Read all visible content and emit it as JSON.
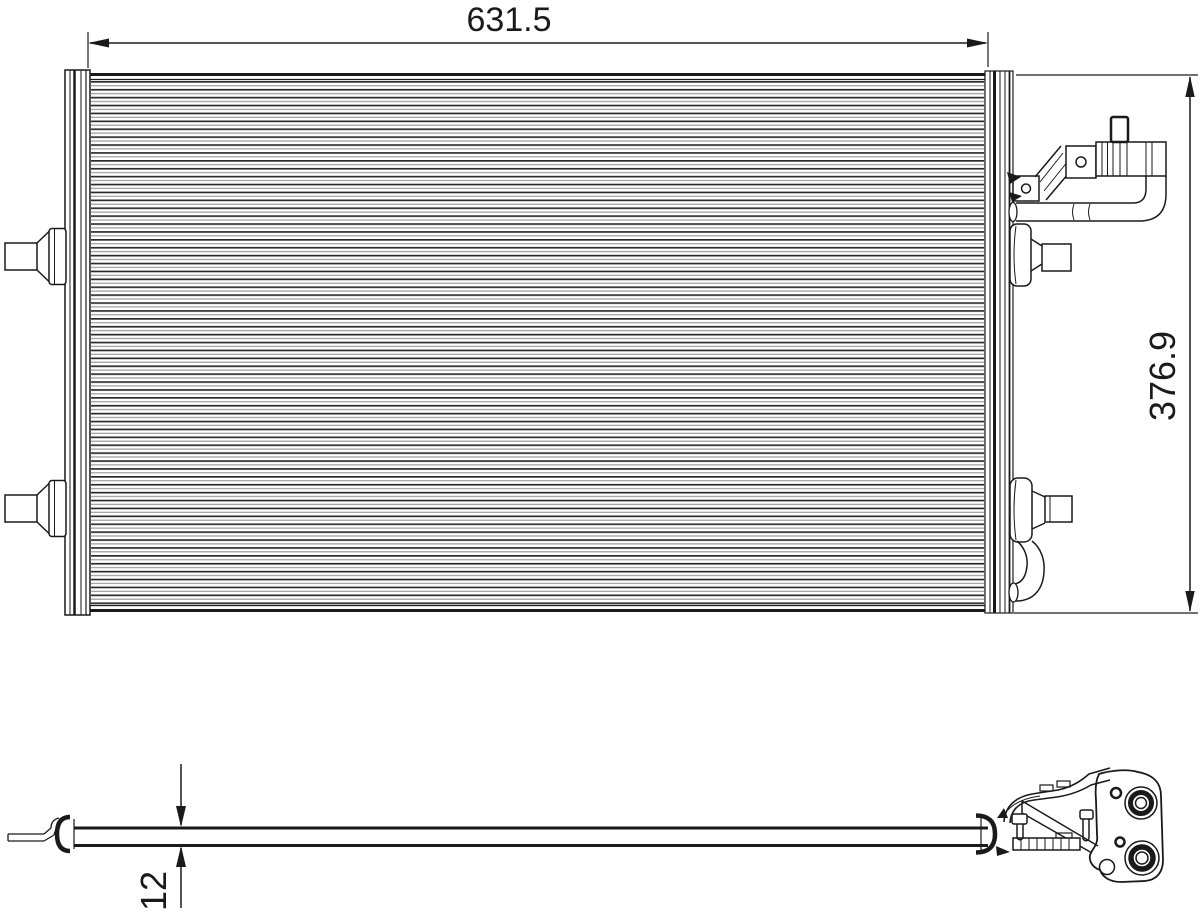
{
  "page": {
    "background_color": "#ffffff"
  },
  "drawing": {
    "line_color": "#1a1a1a",
    "fin_line_color_dark": "#2b2b2b",
    "fin_line_color_light": "#9a9a9a",
    "dimensions": {
      "width": "631.5",
      "height": "376.9",
      "thickness": "12"
    }
  }
}
